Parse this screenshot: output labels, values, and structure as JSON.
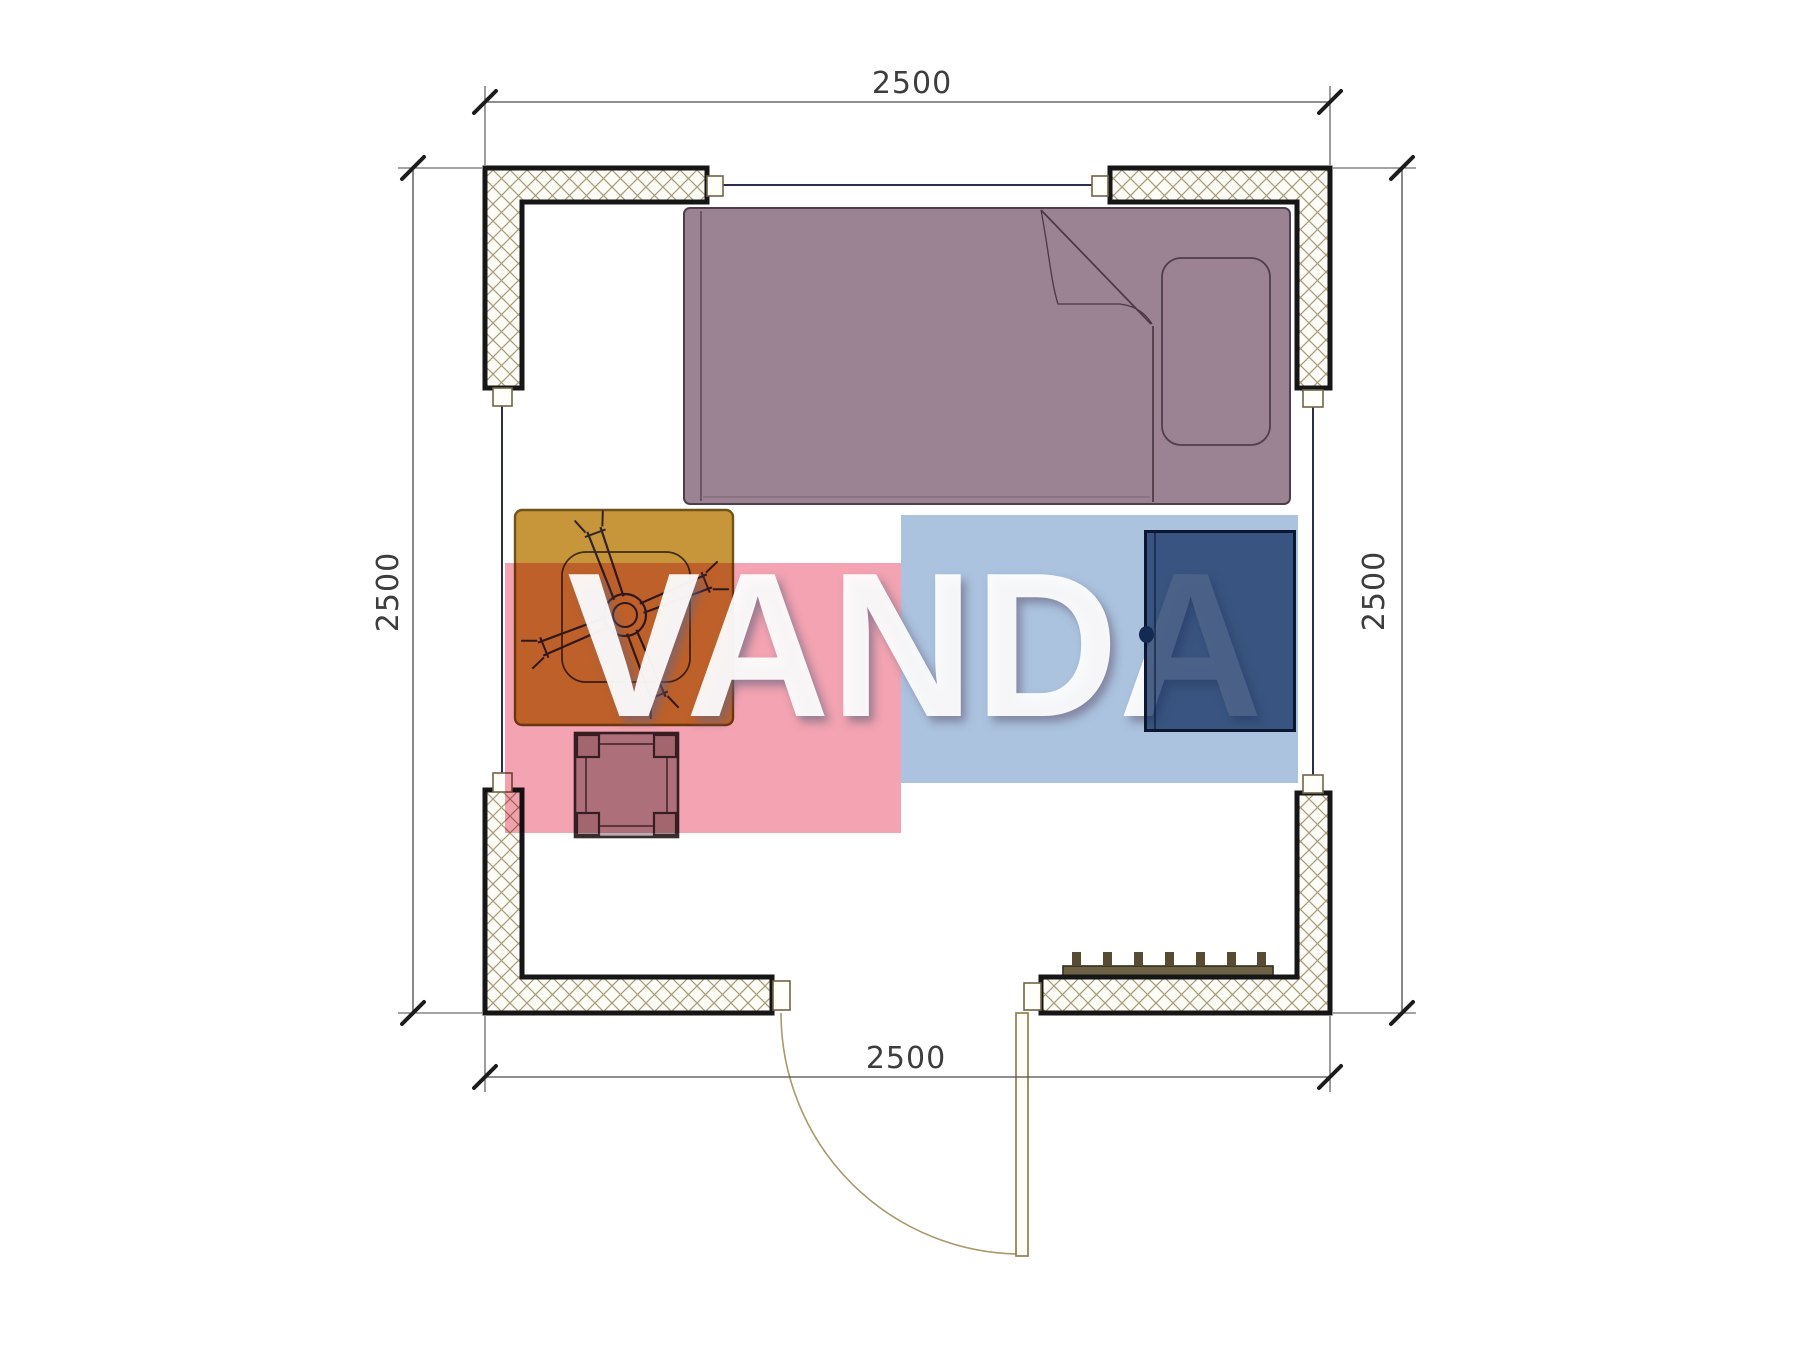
{
  "page": {
    "type": "architectural-floor-plan",
    "background_color": "#ffffff",
    "description": "Top-view plan of a 2500x2500 room with bed, desk, office chair, stool, cabinet, radiator, window openings and an outward-swinging door"
  },
  "dimensions": {
    "top": "2500",
    "bottom": "2500",
    "left": "2500",
    "right": "2500"
  },
  "watermark": {
    "text": "VANDA",
    "red_block_color": "#f3a3b1",
    "blue_block_color": "#abc3df",
    "text_color": "#ffffff"
  },
  "walls": {
    "outline_color": "#161616",
    "hatch_color": "#a59a77",
    "fill_color": "#fdfcf7"
  },
  "furniture": {
    "bed": {
      "name": "single-bed",
      "fill": "#9c8393",
      "outline": "#4f3f4b"
    },
    "pillow": {
      "name": "pillow",
      "fill": "#9c8393"
    },
    "desk": {
      "name": "desk",
      "fill": "#c8963a",
      "outline": "#6f5318"
    },
    "office_chair": {
      "name": "office-chair",
      "stroke": "#332427"
    },
    "stool": {
      "name": "stool",
      "fill": "#b6aeae",
      "outline": "#392d2f"
    },
    "cabinet": {
      "name": "cabinet",
      "fill": "#1a3061",
      "knob": "#132a52"
    },
    "radiator": {
      "name": "radiator",
      "fill": "#6e6246"
    },
    "door": {
      "name": "door-leaf-and-swing-arc",
      "stroke": "#8f8050"
    }
  }
}
